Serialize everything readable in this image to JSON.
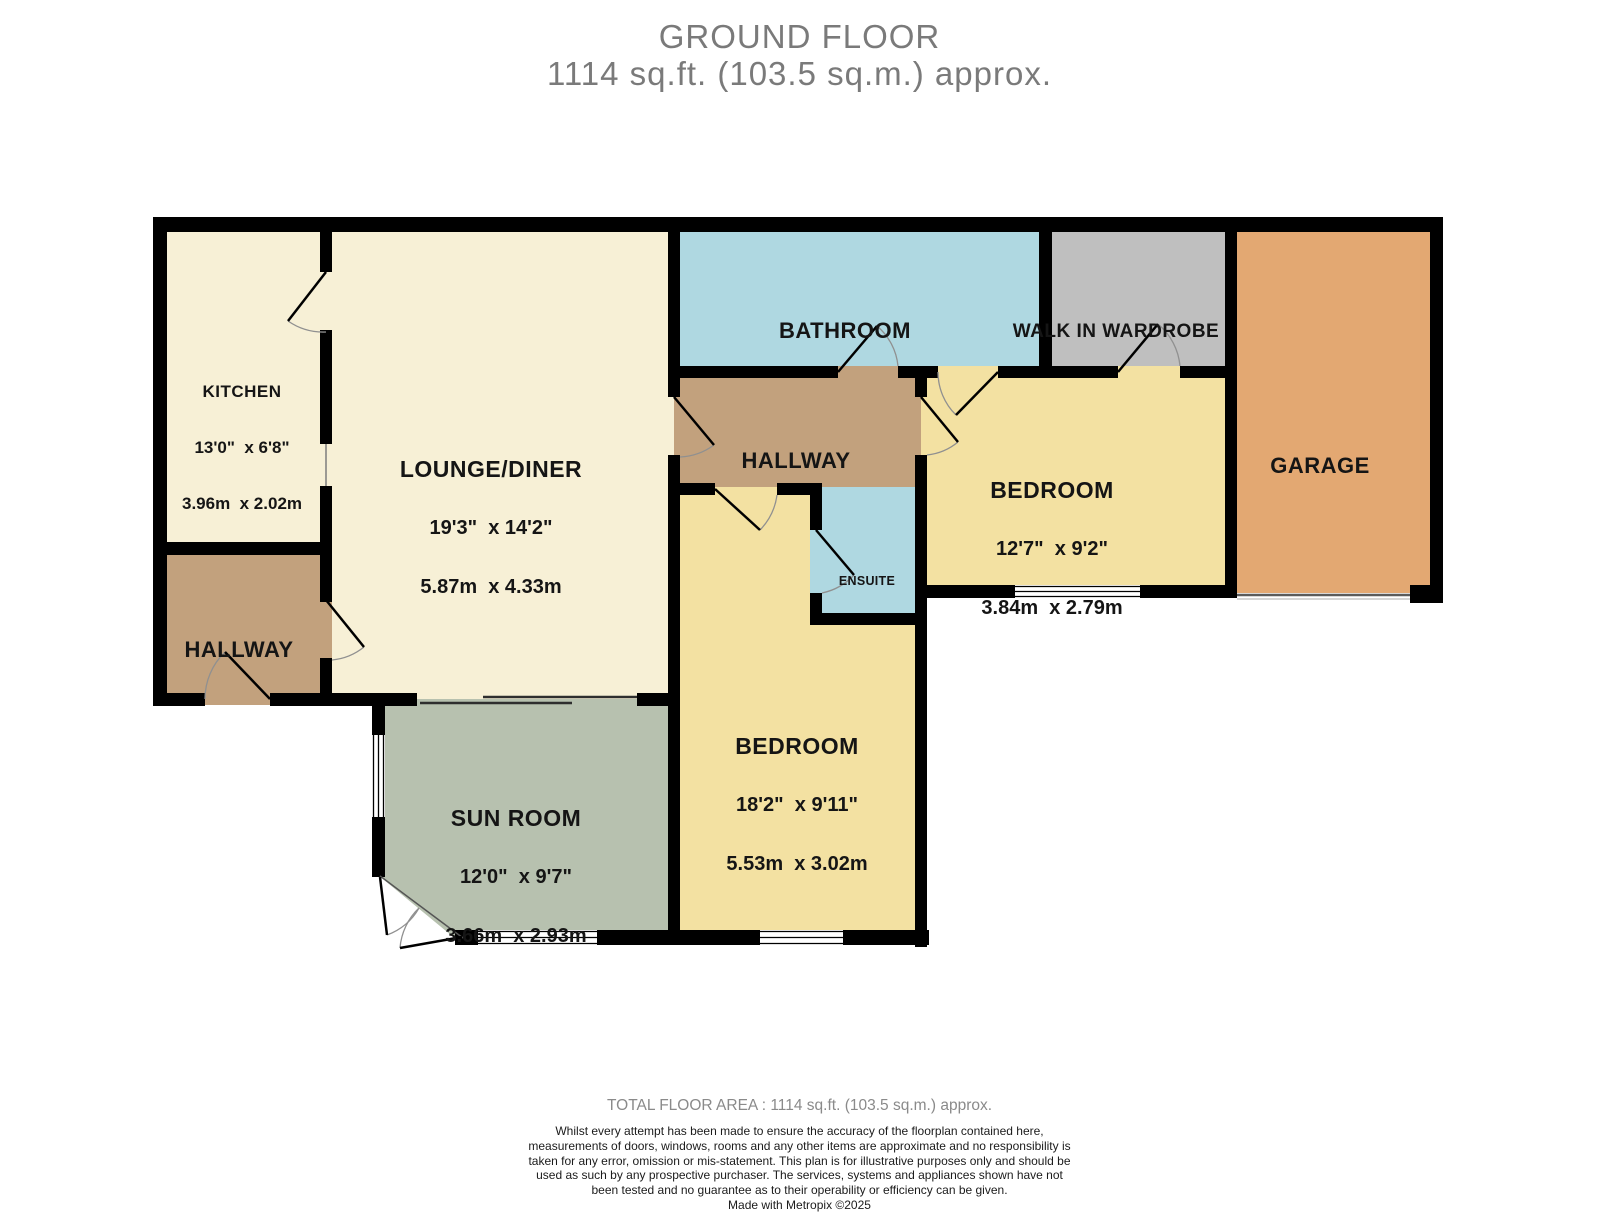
{
  "title": {
    "line1": "GROUND FLOOR",
    "line2": "1114 sq.ft. (103.5 sq.m.) approx."
  },
  "rooms": {
    "kitchen": {
      "name": "KITCHEN",
      "imp": "13'0\"  x 6'8\"",
      "met": "3.96m  x 2.02m"
    },
    "lounge": {
      "name": "LOUNGE/DINER",
      "imp": "19'3\"  x 14'2\"",
      "met": "5.87m  x 4.33m"
    },
    "bathroom": {
      "name": "BATHROOM"
    },
    "wardrobe": {
      "name": "WALK IN WARDROBE"
    },
    "hallway_left": {
      "name": "HALLWAY"
    },
    "hallway_center": {
      "name": "HALLWAY"
    },
    "bedroom_right": {
      "name": "BEDROOM",
      "imp": "12'7\"  x 9'2\"",
      "met": "3.84m  x 2.79m"
    },
    "garage": {
      "name": "GARAGE"
    },
    "ensuite": {
      "name": "ENSUITE"
    },
    "bedroom_bottom": {
      "name": "BEDROOM",
      "imp": "18'2\"  x 9'11\"",
      "met": "5.53m  x 3.02m"
    },
    "sunroom": {
      "name": "SUN ROOM",
      "imp": "12'0\"  x 9'7\"",
      "met": "3.66m  x 2.93m"
    }
  },
  "footer": {
    "total": "TOTAL FLOOR AREA : 1114 sq.ft. (103.5 sq.m.) approx.",
    "disclaimer": "Whilst every attempt has been made to ensure the accuracy of the floorplan contained here, measurements of doors, windows, rooms and any other items are approximate and no responsibility is taken for any error, omission or mis-statement. This plan is for illustrative purposes only and should be used as such by any prospective purchaser. The services, systems and appliances shown have not been tested and no guarantee as to their operability or efficiency can be given.",
    "credit": "Made with Metropix ©2025"
  },
  "colors": {
    "cream": "#F7F0D6",
    "bedroom_yellow": "#F3E1A2",
    "bath_blue": "#AFD8E1",
    "wardrobe_gray": "#BFBFBF",
    "garage_orange": "#E3A872",
    "hallway_brown": "#C2A17D",
    "sunroom_green": "#B7C1AF",
    "wall": "#000000"
  }
}
